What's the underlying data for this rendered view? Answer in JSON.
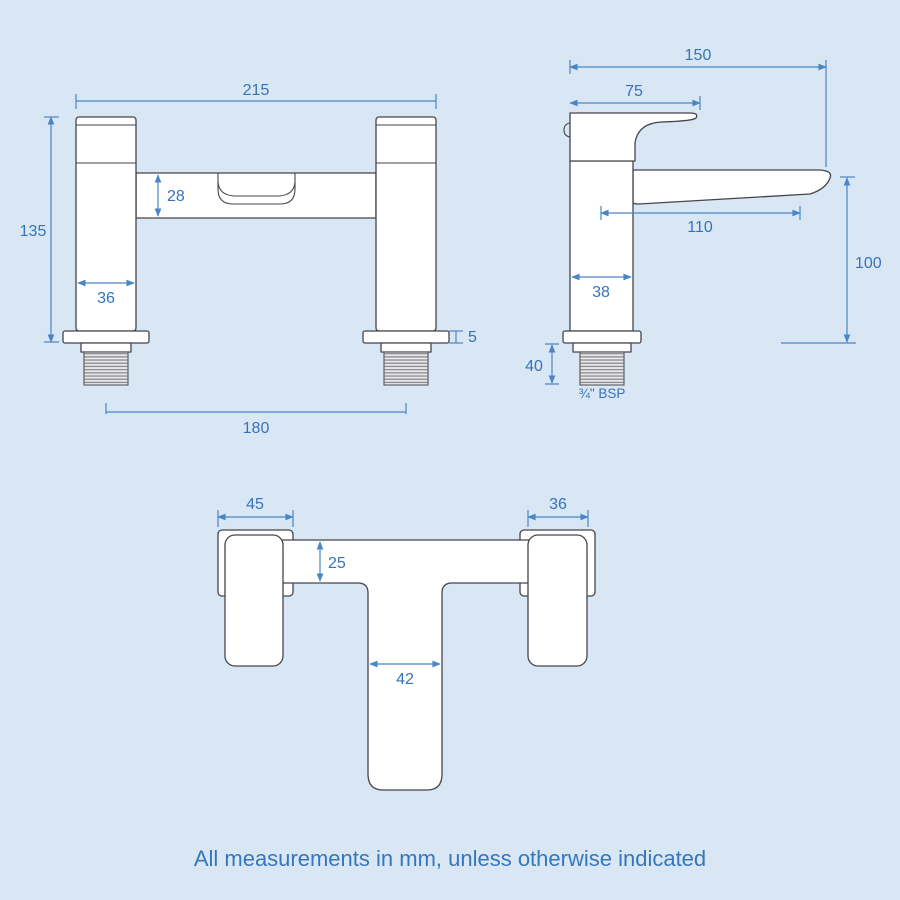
{
  "diagram": {
    "note": "All measurements in mm, unless otherwise indicated"
  },
  "colors": {
    "background": "#d9e7f5",
    "dimension_blue": "#3d7dc2",
    "outline_gray": "#45454c",
    "shape_fill": "#ffffff"
  },
  "front_view": {
    "overall_width": "215",
    "overall_height": "135",
    "crossbar_height": "28",
    "pillar_width": "36",
    "base_plate_thickness": "5",
    "inlet_centres": "180"
  },
  "side_view": {
    "overall_depth": "150",
    "handle_length": "75",
    "spout_reach": "110",
    "body_depth": "38",
    "spout_height": "100",
    "thread_length": "40",
    "thread_spec": "¾\" BSP"
  },
  "top_view": {
    "body_width": "45",
    "handle_width": "36",
    "crossbar_depth": "25",
    "spout_width": "42"
  }
}
